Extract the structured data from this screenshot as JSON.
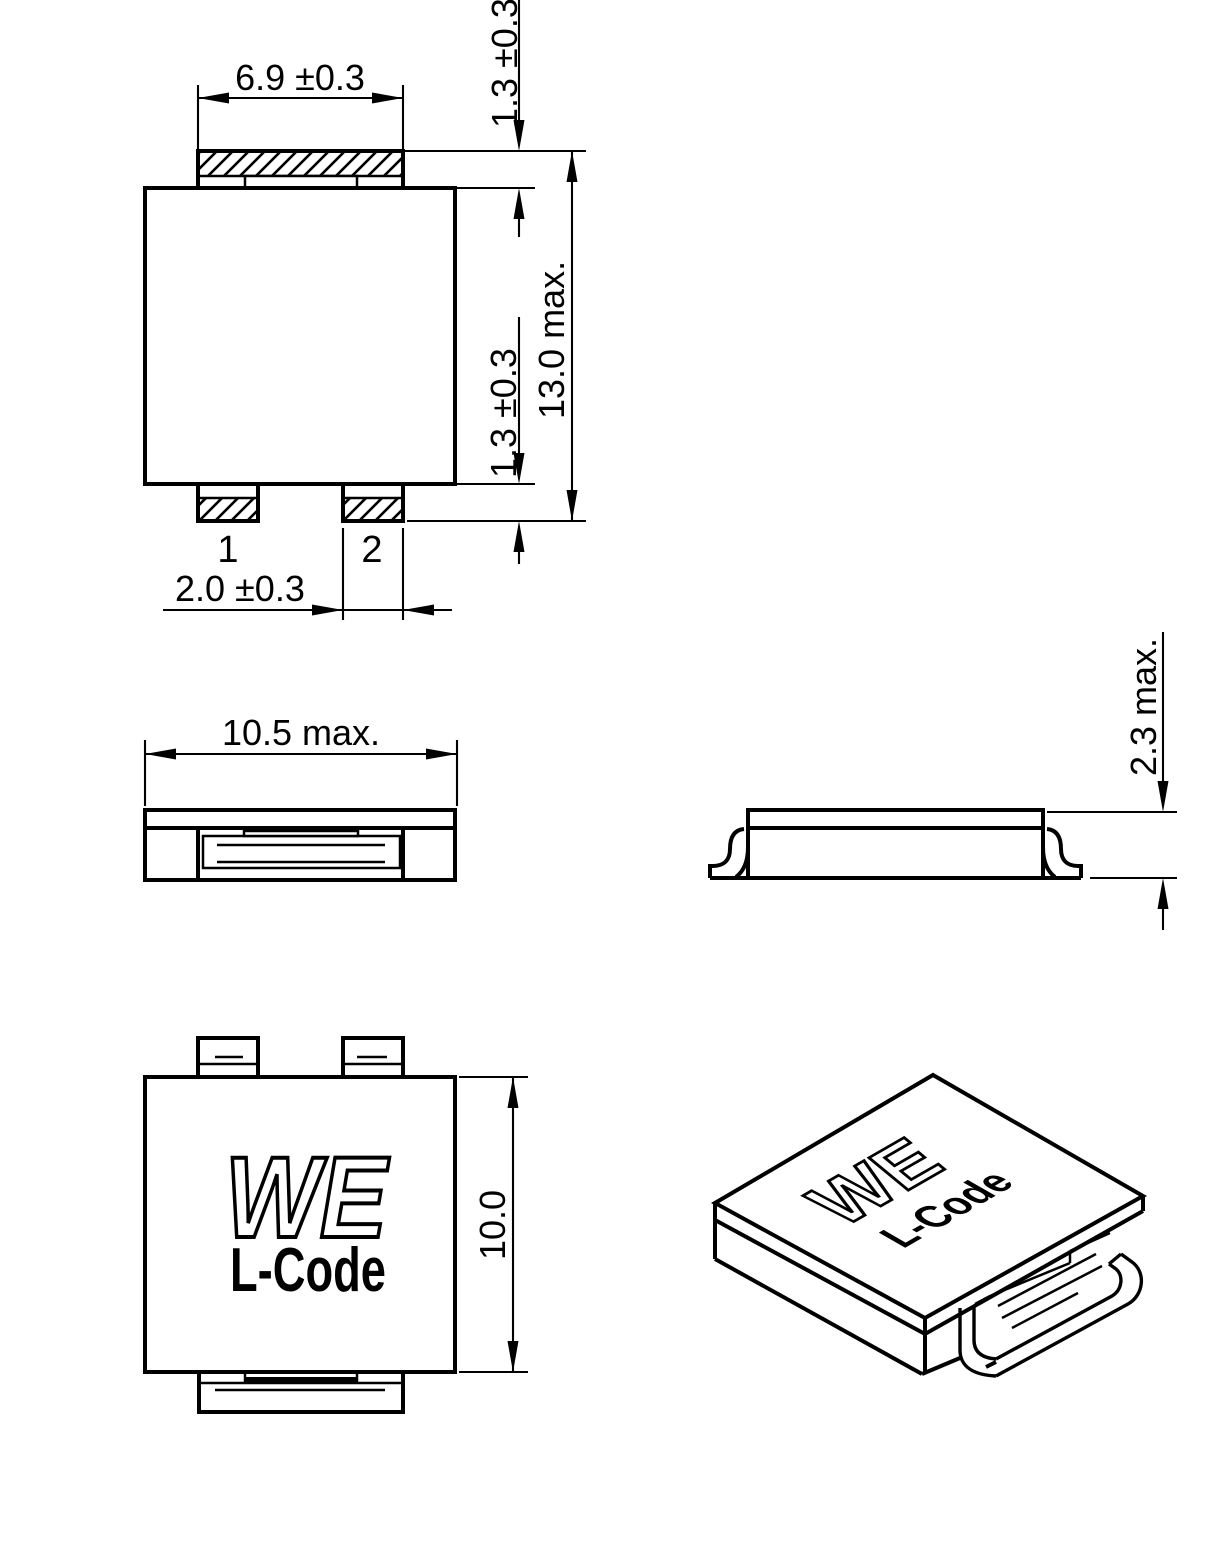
{
  "views": {
    "top": {
      "dim_pad_width": "6.9 ±0.3",
      "dim_top_terminal": "1.3 ±0.3",
      "dim_bottom_terminal": "1.3 ±0.3",
      "dim_overall_length": "13.0 max.",
      "dim_terminal_width": "2.0 ±0.3",
      "pin1": "1",
      "pin2": "2"
    },
    "front": {
      "dim_overall_width": "10.5 max."
    },
    "side": {
      "dim_overall_height": "2.3 max."
    },
    "bottom": {
      "dim_body_length": "10.0",
      "marking_logo": "WE",
      "marking_code": "L-Code"
    },
    "iso": {
      "marking_logo": "WE",
      "marking_code": "L-Code"
    }
  },
  "colors": {
    "line": "#000000",
    "background": "#ffffff"
  }
}
